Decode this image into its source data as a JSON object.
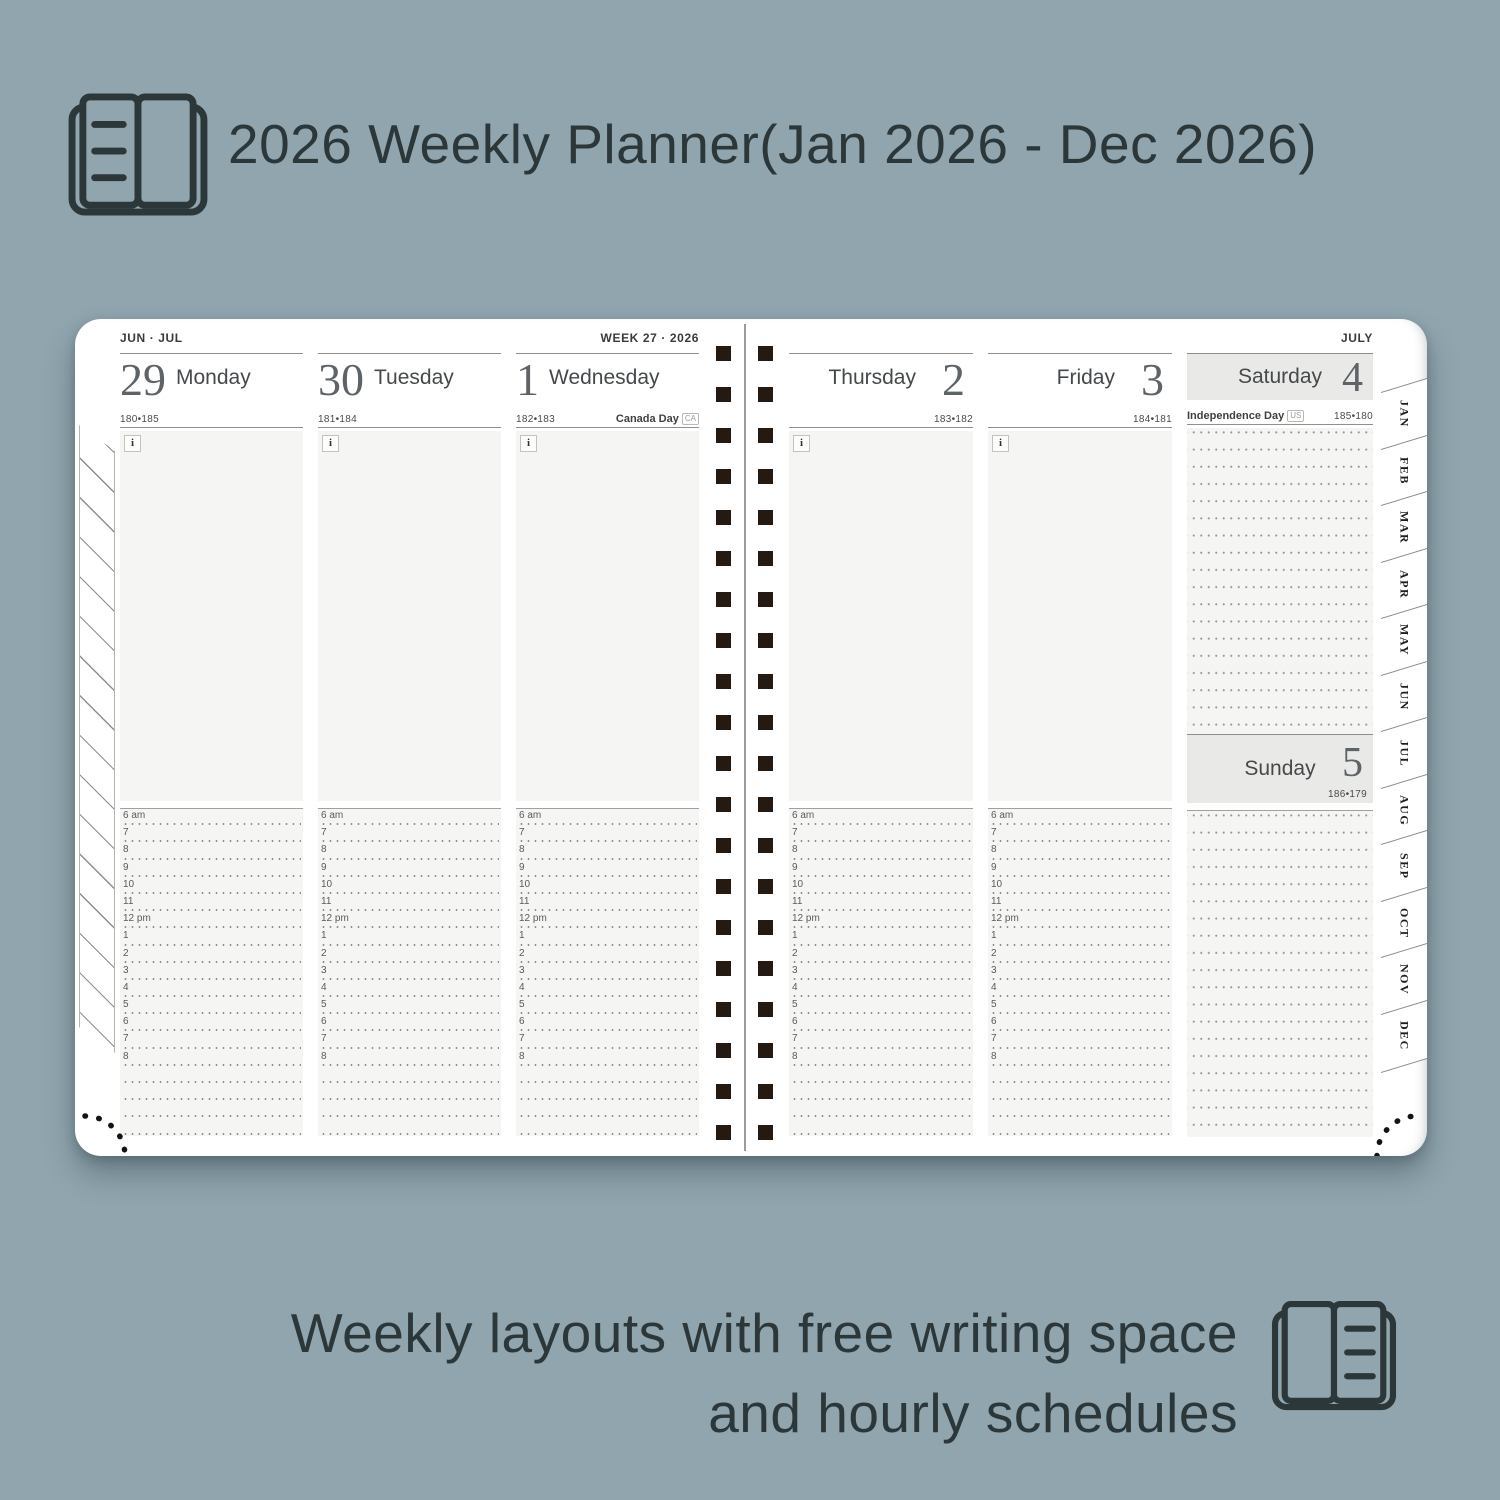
{
  "header": {
    "title": "2026 Weekly Planner(Jan 2026 - Dec 2026)"
  },
  "footer": {
    "line1": "Weekly layouts with free writing space",
    "line2": "and hourly schedules"
  },
  "planner": {
    "left_page_label": "JUN · JUL",
    "week_label": "WEEK 27 · 2026",
    "right_page_label": "JULY",
    "info_icon": "i",
    "days": [
      {
        "number": "29",
        "name": "Monday",
        "day_count": "180•185"
      },
      {
        "number": "30",
        "name": "Tuesday",
        "day_count": "181•184"
      },
      {
        "number": "1",
        "name": "Wednesday",
        "day_count": "182•183",
        "holiday": "Canada Day",
        "holiday_badge": "CA"
      },
      {
        "number": "2",
        "name": "Thursday",
        "day_count": "183•182"
      },
      {
        "number": "3",
        "name": "Friday",
        "day_count": "184•181"
      },
      {
        "number": "4",
        "name": "Saturday",
        "day_count": "185•180",
        "holiday": "Independence Day",
        "holiday_badge": "US"
      },
      {
        "number": "5",
        "name": "Sunday",
        "day_count": "186•179"
      }
    ],
    "hours": [
      "6 am",
      "7",
      "8",
      "9",
      "10",
      "11",
      "12 pm",
      "1",
      "2",
      "3",
      "4",
      "5",
      "6",
      "7",
      "8"
    ],
    "month_tabs": [
      "JAN",
      "FEB",
      "MAR",
      "APR",
      "MAY",
      "JUN",
      "JUL",
      "AUG",
      "SEP",
      "OCT",
      "NOV",
      "DEC"
    ]
  },
  "colors": {
    "background": "#90a5ae",
    "text": "#2c373a",
    "page_white": "#ffffff",
    "panel_gray": "#f5f5f3",
    "header_gray": "#e9e9e7",
    "spiral_hole": "#251a12"
  }
}
